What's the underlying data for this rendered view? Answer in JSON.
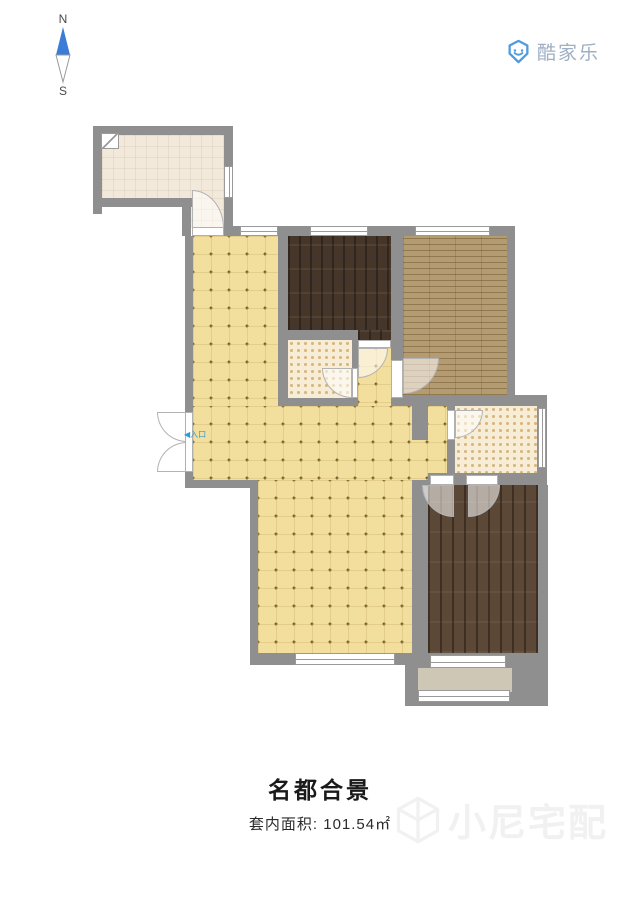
{
  "compass": {
    "north": "N",
    "south": "S"
  },
  "brand": {
    "name": "酷家乐",
    "icon": "smiley-shield",
    "icon_color": "#4E9BE0",
    "text_color": "#9FAFC4"
  },
  "plan": {
    "entrance_label": "◀入口",
    "entrance_label_color": "#2E9BD6",
    "colors": {
      "wall": "#8F8F8F",
      "hall_floor": "#F2DE9D",
      "kitchen_floor": "#F3E9DB",
      "bedroom_top_floor": "#46362A",
      "bedroom_right_floor": "#B59B72",
      "bedroom_bottom_floor": "#5C4836",
      "bathroom_floor": "#F7EDD6",
      "balcony_floor": "#CFC7B6"
    }
  },
  "footer": {
    "title": "名都合景",
    "area_label": "套内面积: 101.54㎡"
  },
  "watermark": {
    "text": "小尼宅配",
    "icon": "cube",
    "color": "#F1F1F1"
  }
}
